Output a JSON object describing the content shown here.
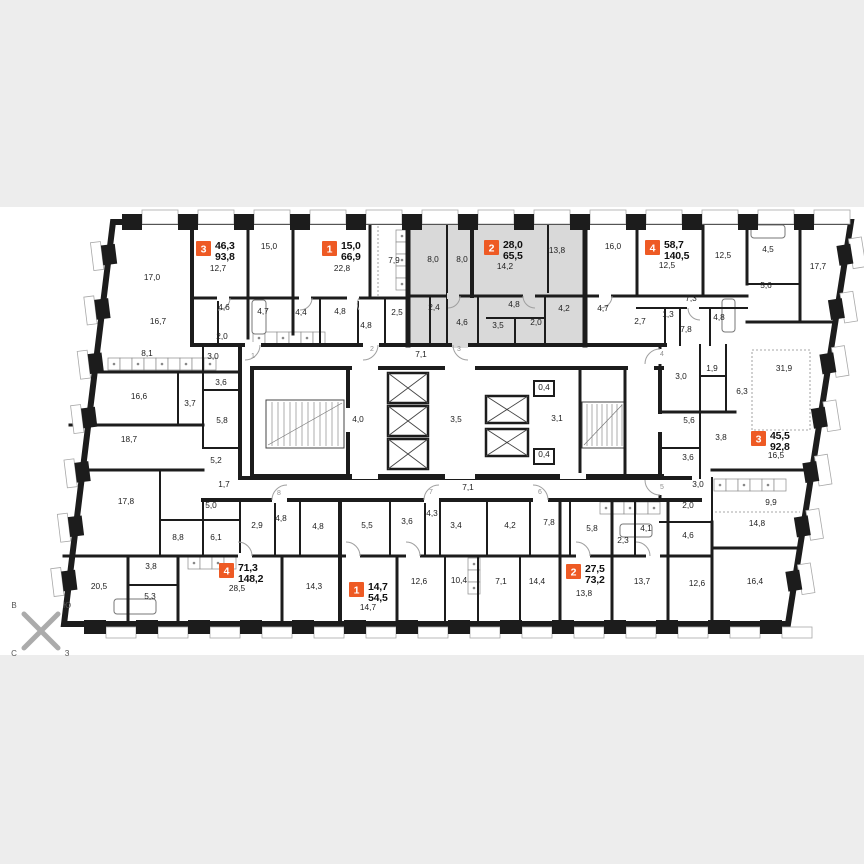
{
  "plan": {
    "kind": "residential-floor-plan"
  },
  "colors": {
    "badge": "#ee5a24",
    "selected_fill": "#d9d9d9",
    "wall": "#1c1c1c",
    "band": "#ededed",
    "paper": "#ffffff",
    "label": "#222222",
    "door_number": "#8f8f8f"
  },
  "compass": {
    "top_left": "В",
    "top_right": "Ю",
    "bottom_left": "С",
    "bottom_right": "З"
  },
  "apartments": [
    {
      "num": "3",
      "living": "46,3",
      "total": "93,8",
      "x": 196,
      "y": 241,
      "selected": false
    },
    {
      "num": "1",
      "living": "15,0",
      "total": "66,9",
      "x": 322,
      "y": 241,
      "selected": false
    },
    {
      "num": "2",
      "living": "28,0",
      "total": "65,5",
      "x": 484,
      "y": 240,
      "selected": true
    },
    {
      "num": "4",
      "living": "58,7",
      "total": "140,5",
      "x": 645,
      "y": 240,
      "selected": false
    },
    {
      "num": "3",
      "living": "45,5",
      "total": "92,8",
      "x": 751,
      "y": 431,
      "selected": false
    },
    {
      "num": "4",
      "living": "71,3",
      "total": "148,2",
      "x": 219,
      "y": 563,
      "selected": false
    },
    {
      "num": "1",
      "living": "14,7",
      "total": "54,5",
      "x": 349,
      "y": 582,
      "selected": false
    },
    {
      "num": "2",
      "living": "27,5",
      "total": "73,2",
      "x": 566,
      "y": 564,
      "selected": false
    }
  ],
  "room_labels": [
    {
      "t": "17,0",
      "x": 152,
      "y": 280
    },
    {
      "t": "12,7",
      "x": 218,
      "y": 271
    },
    {
      "t": "15,0",
      "x": 269,
      "y": 249
    },
    {
      "t": "22,8",
      "x": 342,
      "y": 271
    },
    {
      "t": "7,9",
      "x": 394,
      "y": 263
    },
    {
      "t": "8,0",
      "x": 433,
      "y": 262
    },
    {
      "t": "8,0",
      "x": 462,
      "y": 262
    },
    {
      "t": "14,2",
      "x": 505,
      "y": 269
    },
    {
      "t": "13,8",
      "x": 557,
      "y": 253
    },
    {
      "t": "16,0",
      "x": 613,
      "y": 249
    },
    {
      "t": "12,5",
      "x": 667,
      "y": 268
    },
    {
      "t": "12,5",
      "x": 723,
      "y": 258
    },
    {
      "t": "4,5",
      "x": 768,
      "y": 252
    },
    {
      "t": "5,6",
      "x": 766,
      "y": 288
    },
    {
      "t": "17,7",
      "x": 818,
      "y": 269
    },
    {
      "t": "16,7",
      "x": 158,
      "y": 324
    },
    {
      "t": "4,6",
      "x": 224,
      "y": 310
    },
    {
      "t": "2,0",
      "x": 222,
      "y": 339
    },
    {
      "t": "3,0",
      "x": 213,
      "y": 359
    },
    {
      "t": "4,7",
      "x": 263,
      "y": 314
    },
    {
      "t": "4,4",
      "x": 301,
      "y": 315
    },
    {
      "t": "4,8",
      "x": 340,
      "y": 314
    },
    {
      "t": "2,5",
      "x": 397,
      "y": 315
    },
    {
      "t": "4,8",
      "x": 366,
      "y": 328
    },
    {
      "t": "2,4",
      "x": 434,
      "y": 310
    },
    {
      "t": "4,6",
      "x": 462,
      "y": 325
    },
    {
      "t": "3,5",
      "x": 498,
      "y": 328
    },
    {
      "t": "4,8",
      "x": 514,
      "y": 307
    },
    {
      "t": "2,0",
      "x": 536,
      "y": 325
    },
    {
      "t": "4,2",
      "x": 564,
      "y": 311
    },
    {
      "t": "4,7",
      "x": 603,
      "y": 311
    },
    {
      "t": "2,7",
      "x": 640,
      "y": 324
    },
    {
      "t": "1,3",
      "x": 668,
      "y": 317
    },
    {
      "t": "7,3",
      "x": 691,
      "y": 301
    },
    {
      "t": "7,8",
      "x": 686,
      "y": 332
    },
    {
      "t": "4,8",
      "x": 719,
      "y": 320
    },
    {
      "t": "8,1",
      "x": 147,
      "y": 356
    },
    {
      "t": "7,1",
      "x": 421,
      "y": 357
    },
    {
      "t": "16,6",
      "x": 139,
      "y": 399
    },
    {
      "t": "3,6",
      "x": 221,
      "y": 385
    },
    {
      "t": "3,7",
      "x": 190,
      "y": 406
    },
    {
      "t": "5,8",
      "x": 222,
      "y": 423
    },
    {
      "t": "18,7",
      "x": 129,
      "y": 442
    },
    {
      "t": "5,2",
      "x": 216,
      "y": 463
    },
    {
      "t": "4,0",
      "x": 358,
      "y": 422
    },
    {
      "t": "3,5",
      "x": 456,
      "y": 422
    },
    {
      "t": "0,4",
      "x": 544,
      "y": 390
    },
    {
      "t": "3,1",
      "x": 557,
      "y": 421
    },
    {
      "t": "0,4",
      "x": 544,
      "y": 457
    },
    {
      "t": "3,0",
      "x": 681,
      "y": 379
    },
    {
      "t": "1,9",
      "x": 712,
      "y": 371
    },
    {
      "t": "6,3",
      "x": 742,
      "y": 394
    },
    {
      "t": "31,9",
      "x": 784,
      "y": 371
    },
    {
      "t": "5,6",
      "x": 689,
      "y": 423
    },
    {
      "t": "3,8",
      "x": 721,
      "y": 440
    },
    {
      "t": "3,6",
      "x": 688,
      "y": 460
    },
    {
      "t": "16,5",
      "x": 776,
      "y": 458
    },
    {
      "t": "1,7",
      "x": 224,
      "y": 487
    },
    {
      "t": "7,1",
      "x": 468,
      "y": 490
    },
    {
      "t": "3,0",
      "x": 698,
      "y": 487
    },
    {
      "t": "2,0",
      "x": 688,
      "y": 508
    },
    {
      "t": "9,9",
      "x": 771,
      "y": 505
    },
    {
      "t": "14,8",
      "x": 757,
      "y": 526
    },
    {
      "t": "17,8",
      "x": 126,
      "y": 504
    },
    {
      "t": "5,0",
      "x": 211,
      "y": 508
    },
    {
      "t": "6,1",
      "x": 216,
      "y": 540
    },
    {
      "t": "2,9",
      "x": 257,
      "y": 528
    },
    {
      "t": "8,8",
      "x": 178,
      "y": 540
    },
    {
      "t": "4,8",
      "x": 281,
      "y": 521
    },
    {
      "t": "4,8",
      "x": 318,
      "y": 529
    },
    {
      "t": "5,5",
      "x": 367,
      "y": 528
    },
    {
      "t": "3,6",
      "x": 407,
      "y": 524
    },
    {
      "t": "4,3",
      "x": 432,
      "y": 516
    },
    {
      "t": "3,4",
      "x": 456,
      "y": 528
    },
    {
      "t": "4,2",
      "x": 510,
      "y": 528
    },
    {
      "t": "7,8",
      "x": 549,
      "y": 525
    },
    {
      "t": "5,8",
      "x": 592,
      "y": 531
    },
    {
      "t": "2,3",
      "x": 623,
      "y": 543
    },
    {
      "t": "4,1",
      "x": 646,
      "y": 531
    },
    {
      "t": "4,6",
      "x": 688,
      "y": 538
    },
    {
      "t": "20,5",
      "x": 99,
      "y": 589
    },
    {
      "t": "3,8",
      "x": 151,
      "y": 569
    },
    {
      "t": "5,3",
      "x": 150,
      "y": 599
    },
    {
      "t": "28,5",
      "x": 237,
      "y": 591
    },
    {
      "t": "14,3",
      "x": 314,
      "y": 589
    },
    {
      "t": "14,7",
      "x": 368,
      "y": 610
    },
    {
      "t": "12,6",
      "x": 419,
      "y": 584
    },
    {
      "t": "10,4",
      "x": 459,
      "y": 583
    },
    {
      "t": "7,1",
      "x": 501,
      "y": 584
    },
    {
      "t": "14,4",
      "x": 537,
      "y": 584
    },
    {
      "t": "13,8",
      "x": 584,
      "y": 596
    },
    {
      "t": "13,7",
      "x": 642,
      "y": 584
    },
    {
      "t": "12,6",
      "x": 697,
      "y": 586
    },
    {
      "t": "16,4",
      "x": 755,
      "y": 584
    }
  ],
  "door_numbers": [
    {
      "n": "1",
      "x": 253,
      "y": 358
    },
    {
      "n": "2",
      "x": 372,
      "y": 351
    },
    {
      "n": "3",
      "x": 459,
      "y": 351
    },
    {
      "n": "4",
      "x": 662,
      "y": 356
    },
    {
      "n": "5",
      "x": 662,
      "y": 489
    },
    {
      "n": "6",
      "x": 540,
      "y": 494
    },
    {
      "n": "7",
      "x": 431,
      "y": 494
    },
    {
      "n": "8",
      "x": 279,
      "y": 495
    }
  ]
}
